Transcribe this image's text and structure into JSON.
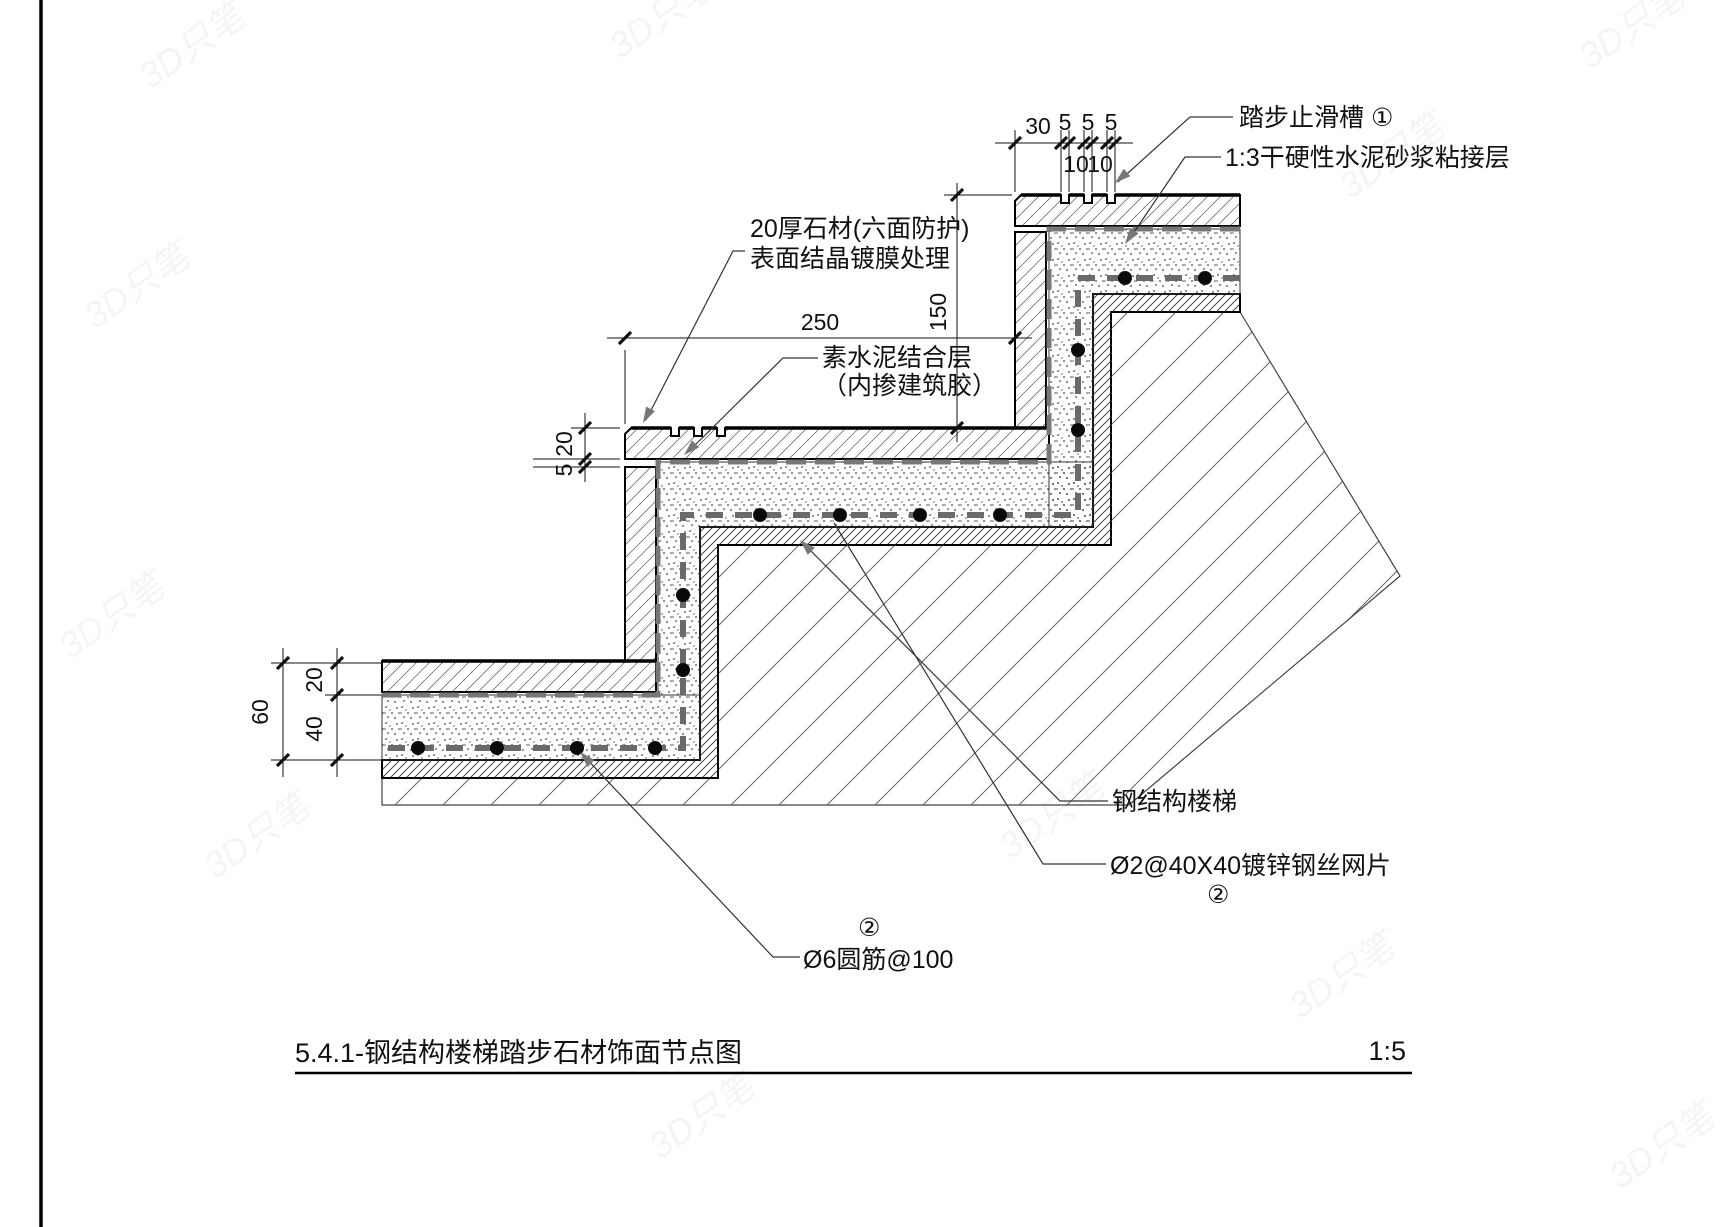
{
  "sheet": {
    "title": "5.4.1-钢结构楼梯踏步石材饰面节点图",
    "scale_label": "1:5"
  },
  "callouts": {
    "antislip": "踏步止滑槽 ①",
    "mortar_bed": "1:3干硬性水泥砂浆粘接层",
    "stone_line1": "20厚石材(六面防护)",
    "stone_line2": "表面结晶镀膜处理",
    "cement_line1": "素水泥结合层",
    "cement_line2": "（内掺建筑胶）",
    "steel_stair": "钢结构楼梯",
    "wire_mesh": "Ø2@40X40镀锌钢丝网片",
    "wire_mesh_num": "②",
    "rebar": "Ø6圆筋@100",
    "rebar_num": "②"
  },
  "dimensions": {
    "groove_offset": "30",
    "groove_w1": "5",
    "groove_w2": "5",
    "groove_w3": "5",
    "groove_gap1": "10",
    "groove_gap2": "10",
    "riser_height": "150",
    "tread_depth": "250",
    "stone_mid": "20",
    "joint_mid": "5",
    "total_left": "60",
    "stone_bot": "20",
    "mortar_bot": "40"
  },
  "watermark": "3D只笔",
  "colors": {
    "line": "#1a1a1a",
    "leader_gray": "#777777",
    "mesh_gray": "#6a6a6a"
  }
}
